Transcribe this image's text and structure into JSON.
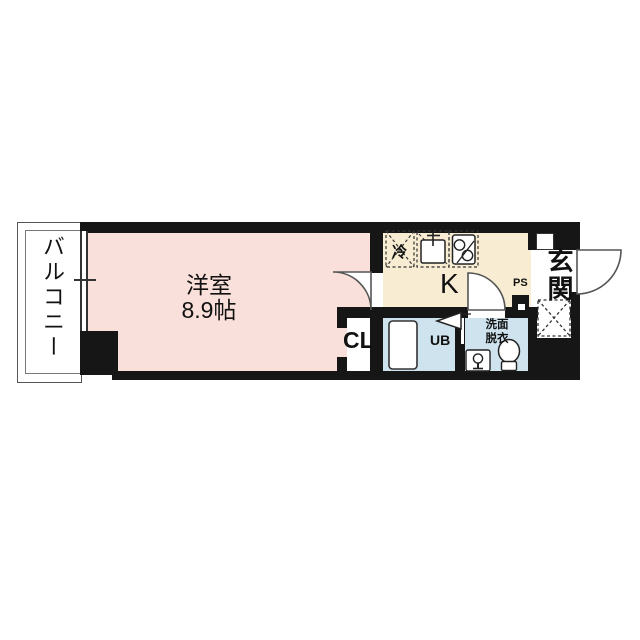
{
  "plan": {
    "type": "apartment-floor-plan",
    "labels": {
      "balcony": "バルコニー",
      "room_name": "洋室",
      "room_size": "8.9帖",
      "kitchen": "K",
      "closet": "CL",
      "unit_bath": "UB",
      "washroom_line1": "洗面",
      "washroom_line2": "脱衣",
      "entrance": "玄関",
      "pipe_space": "PS",
      "refrigerator": "冷"
    },
    "colors": {
      "room_floor": "#fae0da",
      "kitchen_floor": "#f8ecd2",
      "wet_area_floor": "#cfe3ee",
      "wall": "#161616",
      "background": "#ffffff",
      "line": "#555555"
    },
    "icons": [
      "window-icon",
      "door-swing-icon",
      "refrigerator-icon",
      "sink-icon",
      "stove-icon",
      "bathtub-icon",
      "washbasin-icon",
      "toilet-icon",
      "shoe-cabinet-icon",
      "meter-box-icon"
    ]
  }
}
